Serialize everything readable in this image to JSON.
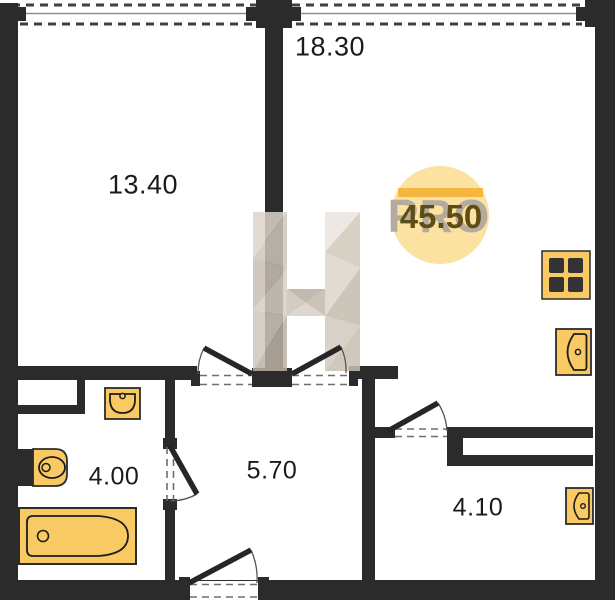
{
  "plan": {
    "title": "apartment-floor-plan",
    "total_area_badge": {
      "value": "45.50",
      "watermark_text": "PRO",
      "circle_color": "#FBE2A1",
      "bar_color": "#F4B63E",
      "value_color": "#5E4D16",
      "watermark_color": "#B4AA9E"
    },
    "rooms": [
      {
        "id": "bedroom",
        "area": "13.40"
      },
      {
        "id": "living-kitchen",
        "area": "18.30"
      },
      {
        "id": "bathroom",
        "area": "4.00"
      },
      {
        "id": "hallway",
        "area": "5.70"
      },
      {
        "id": "storage",
        "area": "4.10"
      }
    ],
    "colors": {
      "wall": "#2b2b2b",
      "fixture_fill": "#F9C963",
      "fixture_stroke": "#2b2b2b",
      "watermark_beige": "#CFC7BB",
      "background": "#ffffff"
    },
    "fixtures": [
      "stove",
      "kitchen-sink",
      "wash-basin",
      "toilet",
      "bathtub",
      "storage-basin"
    ]
  }
}
